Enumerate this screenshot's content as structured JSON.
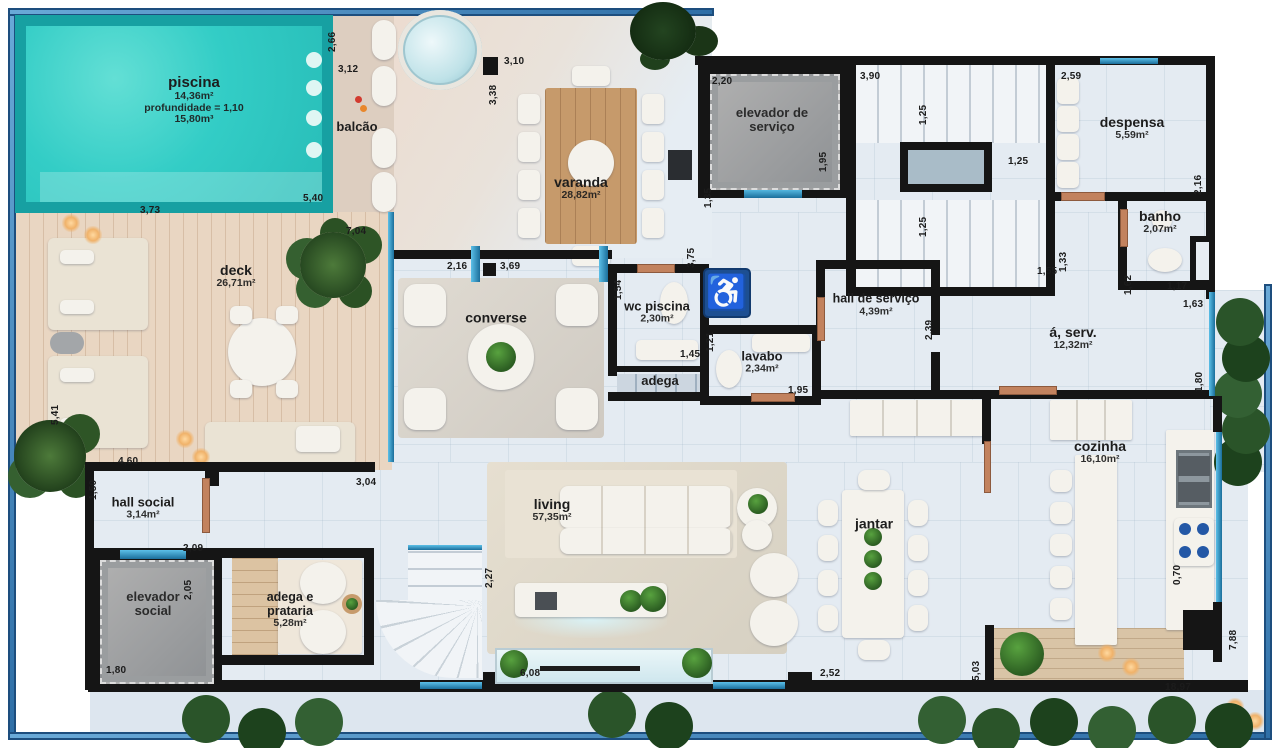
{
  "colors": {
    "pool_water": "#33cdc6",
    "pool_edge": "#17a0a2",
    "frame_blue": "#4f97cc",
    "wall": "#151515",
    "wood_deck": "#e9d6c2",
    "floor": "#e4ebf2",
    "door_copper": "#c2825e",
    "glass_teal": "#2e9fd0",
    "accessibility_blue": "#1d4f92",
    "elevator_gray": "#9a9d9f"
  },
  "icons": {
    "accessibility_symbol": "♿"
  },
  "rooms": {
    "piscina": {
      "name": "piscina",
      "area": "14,36m²",
      "depth": "profundidade = 1,10",
      "volume": "15,80m³"
    },
    "balcao": {
      "name": "balcão"
    },
    "varanda": {
      "name": "varanda",
      "area": "28,82m²"
    },
    "elevador_servico": {
      "name": "elevador de serviço"
    },
    "despensa": {
      "name": "despensa",
      "area": "5,59m²"
    },
    "banho": {
      "name": "banho",
      "area": "2,07m²"
    },
    "deck": {
      "name": "deck",
      "area": "26,71m²"
    },
    "converse": {
      "name": "converse"
    },
    "wc_piscina": {
      "name": "wc piscina",
      "area": "2,30m²"
    },
    "adega": {
      "name": "adega"
    },
    "lavabo": {
      "name": "lavabo",
      "area": "2,34m²"
    },
    "hall_servico": {
      "name": "hall de serviço",
      "area": "4,39m²"
    },
    "area_servico": {
      "name": "á, serv.",
      "area": "12,32m²"
    },
    "cozinha": {
      "name": "cozinha",
      "area": "16,10m²"
    },
    "hall_social": {
      "name": "hall social",
      "area": "3,14m²"
    },
    "elevador_social": {
      "name": "elevador social"
    },
    "adega_prataria": {
      "name": "adega e prataria",
      "area": "5,28m²"
    },
    "living": {
      "name": "living",
      "area": "57,35m²"
    },
    "jantar": {
      "name": "jantar"
    }
  },
  "dims": [
    "2,66",
    "3,12",
    "5,40",
    "3,73",
    "7,04",
    "3,10",
    "3,38",
    "2,20",
    "1,95",
    "3,90",
    "1,25",
    "1,25",
    "1,25",
    "2,59",
    "2,16",
    "1,55",
    "1,33",
    "1,62",
    "1,17",
    "1,63",
    "2,16",
    "3,69",
    "3,75",
    "1,54",
    "1,45",
    "1,21",
    "1,95",
    "2,39",
    "1,80",
    "5,41",
    "4,60",
    "1,50",
    "3,04",
    "2,09",
    "2,05",
    "1,80",
    "2,27",
    "6,08",
    "2,52",
    "5,03",
    "0,70",
    "7,88",
    "18,97",
    "1,35"
  ]
}
